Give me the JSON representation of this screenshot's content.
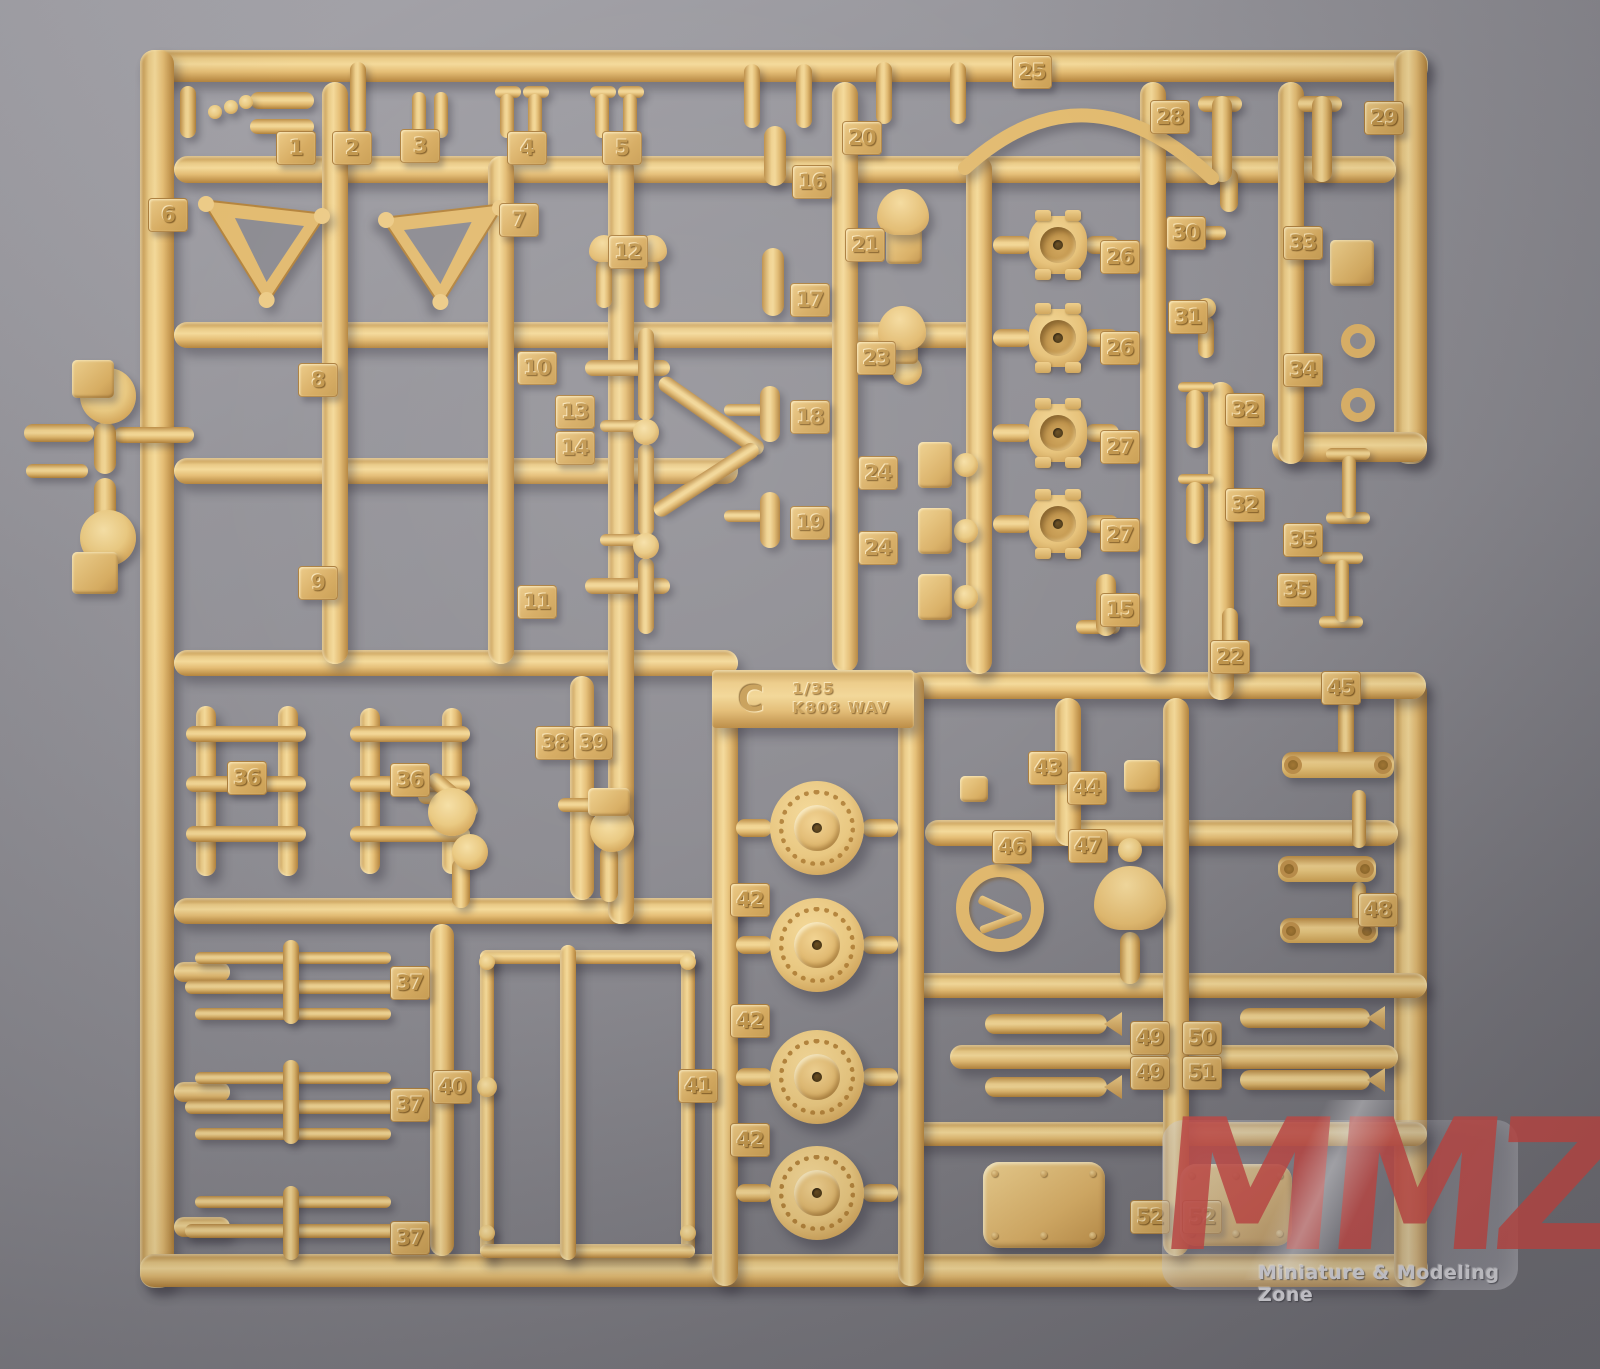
{
  "photo": {
    "subject": "tan plastic model kit sprue C on gray background",
    "colors": {
      "background_light": "#a6a5ab",
      "background_dark": "#6f6e74",
      "plastic_highlight": "#f4d998",
      "plastic_base": "#e4bd74",
      "plastic_shadow": "#b3823a",
      "watermark_red": "#c94c47"
    }
  },
  "label_plate": {
    "sprue_letter": "C",
    "scale": "1/35",
    "kit_code": "K808  WAV",
    "x": 712,
    "y": 670,
    "w": 202,
    "h": 58
  },
  "watermark": {
    "letters": [
      "M",
      "M",
      "Z"
    ],
    "tagline": "Miniature & Modeling Zone"
  },
  "sprue": {
    "frame_runners": [
      [
        140,
        50,
        1288,
        32,
        "h"
      ],
      [
        140,
        50,
        34,
        1238,
        "v"
      ],
      [
        140,
        1254,
        1288,
        33,
        "h"
      ],
      [
        1394,
        50,
        33,
        414,
        "v"
      ],
      [
        1272,
        432,
        155,
        30,
        "h"
      ],
      [
        1394,
        678,
        33,
        609,
        "v"
      ]
    ],
    "inner_runners": [
      [
        174,
        156,
        1222,
        27,
        "h"
      ],
      [
        174,
        322,
        812,
        26,
        "h"
      ],
      [
        174,
        458,
        564,
        26,
        "h"
      ],
      [
        174,
        650,
        564,
        26,
        "h"
      ],
      [
        908,
        672,
        518,
        27,
        "h"
      ],
      [
        174,
        898,
        564,
        26,
        "h"
      ],
      [
        925,
        820,
        473,
        26,
        "h"
      ],
      [
        900,
        973,
        527,
        25,
        "h"
      ],
      [
        950,
        1045,
        448,
        24,
        "h"
      ],
      [
        900,
        1122,
        527,
        24,
        "h"
      ],
      [
        174,
        962,
        56,
        20,
        "h"
      ],
      [
        174,
        1082,
        56,
        20,
        "h"
      ],
      [
        174,
        1217,
        56,
        20,
        "h"
      ],
      [
        322,
        82,
        26,
        582,
        "v"
      ],
      [
        488,
        156,
        26,
        508,
        "v"
      ],
      [
        608,
        156,
        26,
        768,
        "v"
      ],
      [
        712,
        672,
        26,
        614,
        "v"
      ],
      [
        898,
        672,
        26,
        614,
        "v"
      ],
      [
        832,
        82,
        26,
        590,
        "v"
      ],
      [
        966,
        156,
        26,
        518,
        "v"
      ],
      [
        1140,
        82,
        26,
        592,
        "v"
      ],
      [
        1278,
        82,
        26,
        382,
        "v"
      ],
      [
        1208,
        382,
        26,
        318,
        "v"
      ],
      [
        1163,
        698,
        26,
        558,
        "v"
      ],
      [
        1055,
        698,
        26,
        148,
        "v"
      ],
      [
        570,
        676,
        24,
        224,
        "v"
      ],
      [
        430,
        924,
        24,
        332,
        "v"
      ],
      [
        196,
        706,
        20,
        170,
        "v"
      ],
      [
        278,
        706,
        20,
        170,
        "v"
      ],
      [
        360,
        708,
        20,
        166,
        "v"
      ],
      [
        442,
        708,
        20,
        166,
        "v"
      ],
      [
        480,
        950,
        14,
        308,
        "v"
      ],
      [
        681,
        950,
        14,
        308,
        "v"
      ],
      [
        480,
        950,
        215,
        14,
        "h"
      ],
      [
        480,
        1244,
        215,
        14,
        "h"
      ],
      [
        560,
        945,
        16,
        315,
        "v"
      ]
    ],
    "tags": [
      [
        "1",
        296,
        148
      ],
      [
        "2",
        352,
        148
      ],
      [
        "3",
        420,
        146
      ],
      [
        "4",
        527,
        148
      ],
      [
        "5",
        622,
        148
      ],
      [
        "6",
        168,
        215
      ],
      [
        "7",
        519,
        220
      ],
      [
        "12",
        628,
        252
      ],
      [
        "16",
        812,
        182
      ],
      [
        "17",
        810,
        300
      ],
      [
        "18",
        810,
        417
      ],
      [
        "19",
        810,
        523
      ],
      [
        "20",
        862,
        138
      ],
      [
        "21",
        865,
        245
      ],
      [
        "23",
        876,
        358
      ],
      [
        "24",
        878,
        473
      ],
      [
        "24",
        878,
        548
      ],
      [
        "25",
        1032,
        72
      ],
      [
        "28",
        1170,
        117
      ],
      [
        "29",
        1384,
        118
      ],
      [
        "26",
        1120,
        257
      ],
      [
        "26",
        1120,
        348
      ],
      [
        "27",
        1120,
        447
      ],
      [
        "27",
        1120,
        535
      ],
      [
        "15",
        1120,
        610
      ],
      [
        "30",
        1186,
        233
      ],
      [
        "31",
        1188,
        317
      ],
      [
        "33",
        1303,
        243
      ],
      [
        "34",
        1303,
        370
      ],
      [
        "8",
        318,
        380
      ],
      [
        "10",
        537,
        368
      ],
      [
        "13",
        575,
        412
      ],
      [
        "14",
        575,
        448
      ],
      [
        "9",
        318,
        583
      ],
      [
        "11",
        537,
        602
      ],
      [
        "32",
        1245,
        410
      ],
      [
        "32",
        1245,
        505
      ],
      [
        "35",
        1303,
        540
      ],
      [
        "35",
        1297,
        590
      ],
      [
        "22",
        1230,
        657
      ],
      [
        "45",
        1341,
        688
      ],
      [
        "36",
        247,
        778
      ],
      [
        "36",
        410,
        780
      ],
      [
        "38",
        555,
        743
      ],
      [
        "39",
        593,
        743
      ],
      [
        "43",
        1048,
        768
      ],
      [
        "44",
        1087,
        788
      ],
      [
        "46",
        1012,
        847
      ],
      [
        "47",
        1088,
        846
      ],
      [
        "48",
        1378,
        910
      ],
      [
        "42",
        750,
        900
      ],
      [
        "42",
        750,
        1021
      ],
      [
        "42",
        750,
        1140
      ],
      [
        "37",
        410,
        983
      ],
      [
        "37",
        410,
        1105
      ],
      [
        "37",
        410,
        1238
      ],
      [
        "40",
        452,
        1087
      ],
      [
        "41",
        698,
        1086
      ],
      [
        "49",
        1150,
        1038
      ],
      [
        "50",
        1202,
        1038
      ],
      [
        "49",
        1150,
        1073
      ],
      [
        "51",
        1202,
        1073
      ],
      [
        "52",
        1150,
        1217
      ],
      [
        "52",
        1202,
        1217
      ]
    ],
    "parts": {
      "wheel": [
        [
          817,
          828,
          47
        ],
        [
          817,
          945,
          47
        ],
        [
          817,
          1077,
          47
        ],
        [
          817,
          1193,
          47
        ]
      ],
      "hub": [
        [
          1058,
          245,
          29
        ],
        [
          1058,
          338,
          29
        ],
        [
          1058,
          433,
          29
        ],
        [
          1058,
          524,
          29
        ]
      ],
      "tring": [
        [
          1000,
          908,
          44
        ]
      ],
      "dome": [
        [
          604,
          248,
          15
        ],
        [
          652,
          248,
          15
        ],
        [
          903,
          212,
          26
        ],
        [
          902,
          328,
          24
        ],
        [
          1130,
          898,
          36
        ]
      ],
      "hatch": [
        [
          983,
          1162,
          122,
          86
        ],
        [
          1180,
          1164,
          112,
          82
        ]
      ],
      "cannon": [
        [
          985,
          1014,
          122,
          20
        ],
        [
          985,
          1077,
          122,
          20
        ],
        [
          1240,
          1008,
          130,
          20
        ],
        [
          1240,
          1070,
          130,
          20
        ]
      ],
      "link": [
        [
          1282,
          752,
          112,
          26
        ],
        [
          1278,
          856,
          98,
          26
        ],
        [
          1280,
          918,
          98,
          25
        ]
      ],
      "tri": [
        [
          198,
          196,
          132,
          112,
          0
        ],
        [
          378,
          200,
          130,
          110,
          1
        ]
      ],
      "arc": [
        [
          "M 965 168 Q 1085 58 1212 178"
        ]
      ],
      "capv": [
        [
          350,
          62,
          16,
          72
        ],
        [
          412,
          92,
          14,
          46
        ],
        [
          434,
          92,
          14,
          46
        ],
        [
          500,
          94,
          14,
          44
        ],
        [
          528,
          94,
          14,
          44
        ],
        [
          595,
          94,
          14,
          44
        ],
        [
          623,
          94,
          14,
          44
        ],
        [
          180,
          86,
          16,
          52
        ],
        [
          596,
          260,
          16,
          48
        ],
        [
          644,
          260,
          16,
          48
        ],
        [
          744,
          64,
          16,
          64
        ],
        [
          796,
          64,
          16,
          64
        ],
        [
          876,
          62,
          16,
          62
        ],
        [
          950,
          62,
          16,
          62
        ],
        [
          764,
          126,
          22,
          60
        ],
        [
          762,
          248,
          22,
          68
        ],
        [
          760,
          386,
          20,
          56
        ],
        [
          760,
          492,
          20,
          56
        ],
        [
          1220,
          168,
          18,
          44
        ],
        [
          1212,
          96,
          20,
          86
        ],
        [
          1312,
          96,
          20,
          86
        ],
        [
          1198,
          316,
          16,
          42
        ],
        [
          1186,
          390,
          18,
          58
        ],
        [
          1186,
          482,
          18,
          62
        ],
        [
          1342,
          456,
          14,
          62
        ],
        [
          1335,
          560,
          14,
          62
        ],
        [
          1096,
          574,
          20,
          62
        ],
        [
          1222,
          608,
          16,
          42
        ],
        [
          1338,
          700,
          16,
          64
        ],
        [
          1352,
          790,
          14,
          58
        ],
        [
          1352,
          882,
          14,
          40
        ],
        [
          452,
          858,
          18,
          50
        ],
        [
          600,
          846,
          18,
          56
        ],
        [
          1120,
          932,
          20,
          52
        ],
        [
          94,
          422,
          22,
          52
        ],
        [
          94,
          478,
          22,
          52
        ],
        [
          638,
          328,
          16,
          92
        ],
        [
          638,
          444,
          16,
          92
        ],
        [
          638,
          558,
          16,
          76
        ],
        [
          283,
          940,
          16,
          84
        ],
        [
          283,
          1060,
          16,
          84
        ],
        [
          283,
          1186,
          16,
          74
        ]
      ],
      "caph": [
        [
          250,
          92,
          64,
          17
        ],
        [
          250,
          119,
          64,
          15
        ],
        [
          495,
          86,
          26,
          12
        ],
        [
          523,
          86,
          26,
          12
        ],
        [
          590,
          86,
          26,
          12
        ],
        [
          618,
          86,
          26,
          12
        ],
        [
          724,
          404,
          40,
          12
        ],
        [
          724,
          510,
          40,
          12
        ],
        [
          862,
          363,
          40,
          12
        ],
        [
          1198,
          96,
          44,
          16
        ],
        [
          1298,
          96,
          44,
          16
        ],
        [
          1188,
          226,
          38,
          14
        ],
        [
          1184,
          300,
          30,
          12
        ],
        [
          1178,
          382,
          36,
          10
        ],
        [
          1178,
          474,
          36,
          10
        ],
        [
          1326,
          448,
          44,
          12
        ],
        [
          1326,
          512,
          44,
          12
        ],
        [
          1319,
          552,
          44,
          12
        ],
        [
          1319,
          616,
          44,
          12
        ],
        [
          1076,
          620,
          44,
          14
        ],
        [
          418,
          788,
          48,
          16
        ],
        [
          558,
          798,
          40,
          14
        ],
        [
          585,
          360,
          85,
          16
        ],
        [
          585,
          578,
          85,
          16
        ],
        [
          600,
          420,
          56,
          12
        ],
        [
          600,
          534,
          56,
          12
        ],
        [
          24,
          424,
          70,
          18
        ],
        [
          114,
          427,
          80,
          16
        ],
        [
          26,
          464,
          62,
          14
        ],
        [
          186,
          726,
          120,
          16
        ],
        [
          186,
          776,
          120,
          16
        ],
        [
          186,
          826,
          120,
          16
        ],
        [
          350,
          726,
          120,
          16
        ],
        [
          350,
          776,
          120,
          16
        ],
        [
          350,
          826,
          120,
          16
        ],
        [
          195,
          952,
          196,
          12
        ],
        [
          185,
          980,
          216,
          14
        ],
        [
          195,
          1008,
          196,
          12
        ],
        [
          195,
          1072,
          196,
          12
        ],
        [
          185,
          1100,
          216,
          14
        ],
        [
          195,
          1128,
          196,
          12
        ],
        [
          195,
          1196,
          196,
          12
        ],
        [
          185,
          1224,
          216,
          14
        ]
      ],
      "rbar": [
        [
          660,
          372,
          125,
          16,
          35
        ],
        [
          655,
          505,
          122,
          16,
          -33
        ],
        [
          430,
          768,
          60,
          16,
          40
        ]
      ],
      "circle": [
        [
          215,
          112,
          7
        ],
        [
          231,
          107,
          7
        ],
        [
          246,
          102,
          7
        ],
        [
          907,
          370,
          15
        ],
        [
          966,
          465,
          12
        ],
        [
          966,
          531,
          12
        ],
        [
          966,
          597,
          12
        ],
        [
          1194,
          233,
          8
        ],
        [
          1206,
          308,
          10
        ],
        [
          646,
          432,
          13
        ],
        [
          646,
          546,
          13
        ],
        [
          108,
          396,
          28
        ],
        [
          108,
          538,
          28
        ],
        [
          452,
          812,
          24
        ],
        [
          470,
          852,
          18
        ],
        [
          612,
          830,
          22
        ],
        [
          1130,
          850,
          12
        ],
        [
          487,
          1087,
          10
        ],
        [
          688,
          1087,
          10
        ],
        [
          487,
          962,
          8
        ],
        [
          688,
          962,
          8
        ],
        [
          487,
          1233,
          8
        ],
        [
          688,
          1233,
          8
        ]
      ],
      "ring": [
        [
          1352,
          263,
          17,
          7
        ],
        [
          1358,
          341,
          17,
          8
        ],
        [
          1358,
          405,
          17,
          8
        ]
      ],
      "block": [
        [
          886,
          226,
          36,
          38
        ],
        [
          888,
          342,
          30,
          22
        ],
        [
          918,
          442,
          34,
          46
        ],
        [
          918,
          508,
          34,
          46
        ],
        [
          918,
          574,
          34,
          46
        ],
        [
          1330,
          240,
          44,
          46
        ],
        [
          960,
          776,
          28,
          26
        ],
        [
          1124,
          760,
          36,
          32
        ],
        [
          588,
          788,
          42,
          28
        ],
        [
          72,
          360,
          42,
          38
        ],
        [
          72,
          552,
          46,
          42
        ]
      ]
    }
  }
}
